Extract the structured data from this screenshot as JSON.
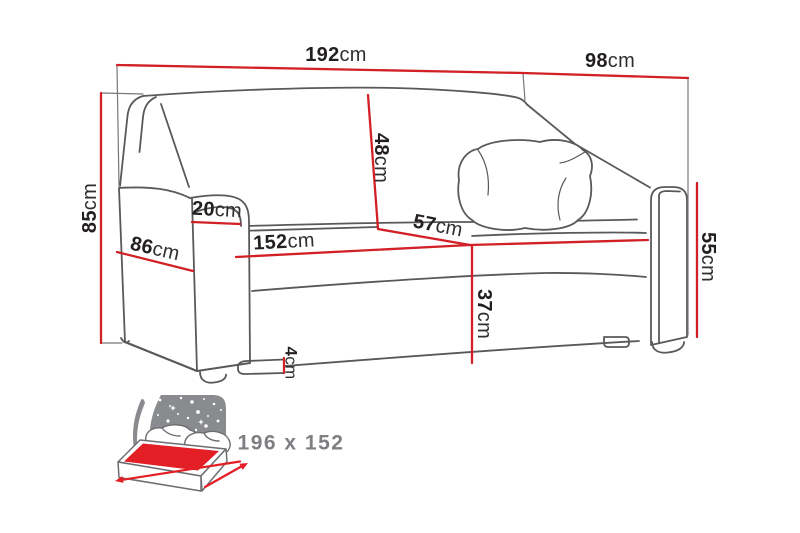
{
  "diagram": {
    "type": "sofa-dimension-drawing",
    "dimensions": [
      {
        "id": "overall-width",
        "value": "192",
        "unit": "cm"
      },
      {
        "id": "overall-depth",
        "value": "98",
        "unit": "cm"
      },
      {
        "id": "overall-height",
        "value": "85",
        "unit": "cm"
      },
      {
        "id": "armrest-depth",
        "value": "86",
        "unit": "cm"
      },
      {
        "id": "armrest-width",
        "value": "20",
        "unit": "cm"
      },
      {
        "id": "backrest-height",
        "value": "48",
        "unit": "cm"
      },
      {
        "id": "seat-depth",
        "value": "57",
        "unit": "cm"
      },
      {
        "id": "seat-width",
        "value": "152",
        "unit": "cm"
      },
      {
        "id": "seat-height",
        "value": "37",
        "unit": "cm"
      },
      {
        "id": "armrest-height",
        "value": "55",
        "unit": "cm"
      },
      {
        "id": "leg-height",
        "value": "4",
        "unit": "cm"
      }
    ],
    "sleeping_area": {
      "label": "196 x 152"
    },
    "colors": {
      "dimension_red": "#D22027",
      "bed_red": "#E31E25",
      "line_gray": "#58595B",
      "extension_gray": "#77787B",
      "panel_gray": "#8A8B8E",
      "text_black": "#231F20",
      "muted_gray": "#7D7F83"
    }
  }
}
